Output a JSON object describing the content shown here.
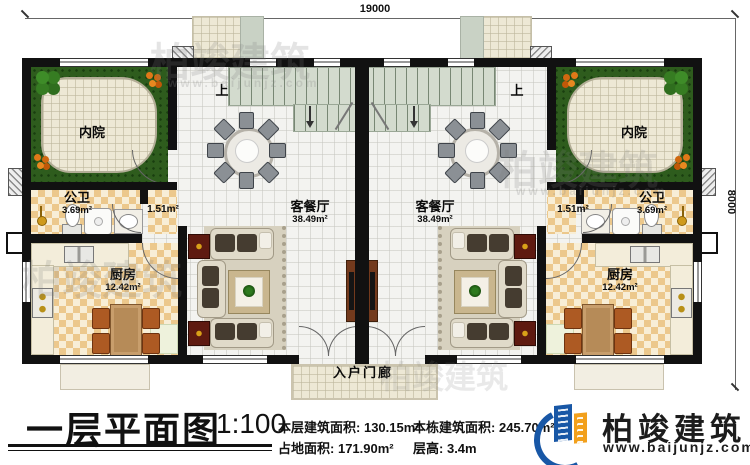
{
  "plan": {
    "dim_width": "19000",
    "dim_height": "8000",
    "left_unit": {
      "courtyard": "内院",
      "bath": "公卫",
      "bath_area": "3.69m²",
      "hall_area": "1.51m²",
      "kitchen": "厨房",
      "kitchen_area": "12.42m²",
      "living": "客餐厅",
      "living_area": "38.49m²",
      "stairs_up": "上"
    },
    "right_unit": {
      "courtyard": "内院",
      "bath": "公卫",
      "bath_area": "3.69m²",
      "hall_area": "1.51m²",
      "kitchen": "厨房",
      "kitchen_area": "12.42m²",
      "living": "客餐厅",
      "living_area": "38.49m²",
      "stairs_up": "上"
    },
    "porch": "入户门廊"
  },
  "watermark": {
    "text": "柏竣建筑",
    "url": "www.baijunjz.com"
  },
  "title_block": {
    "title": "一层平面图",
    "scale": "1:100",
    "stats": [
      {
        "label": "本层建筑面积:",
        "value": "130.15m²"
      },
      {
        "label": "本栋建筑面积:",
        "value": "245.70m²"
      },
      {
        "label": "占地面积:",
        "value": "171.90m²"
      },
      {
        "label": "层高:",
        "value": "3.4m"
      }
    ],
    "brand": {
      "name": "柏竣建筑",
      "url": "www.baijunjz.com"
    }
  },
  "colors": {
    "wall": "#111111",
    "grass": "#2e5c1d",
    "floor_checker": "#ecc88c",
    "brand_blue": "#1857a6",
    "brand_orange": "#f2a01c"
  }
}
